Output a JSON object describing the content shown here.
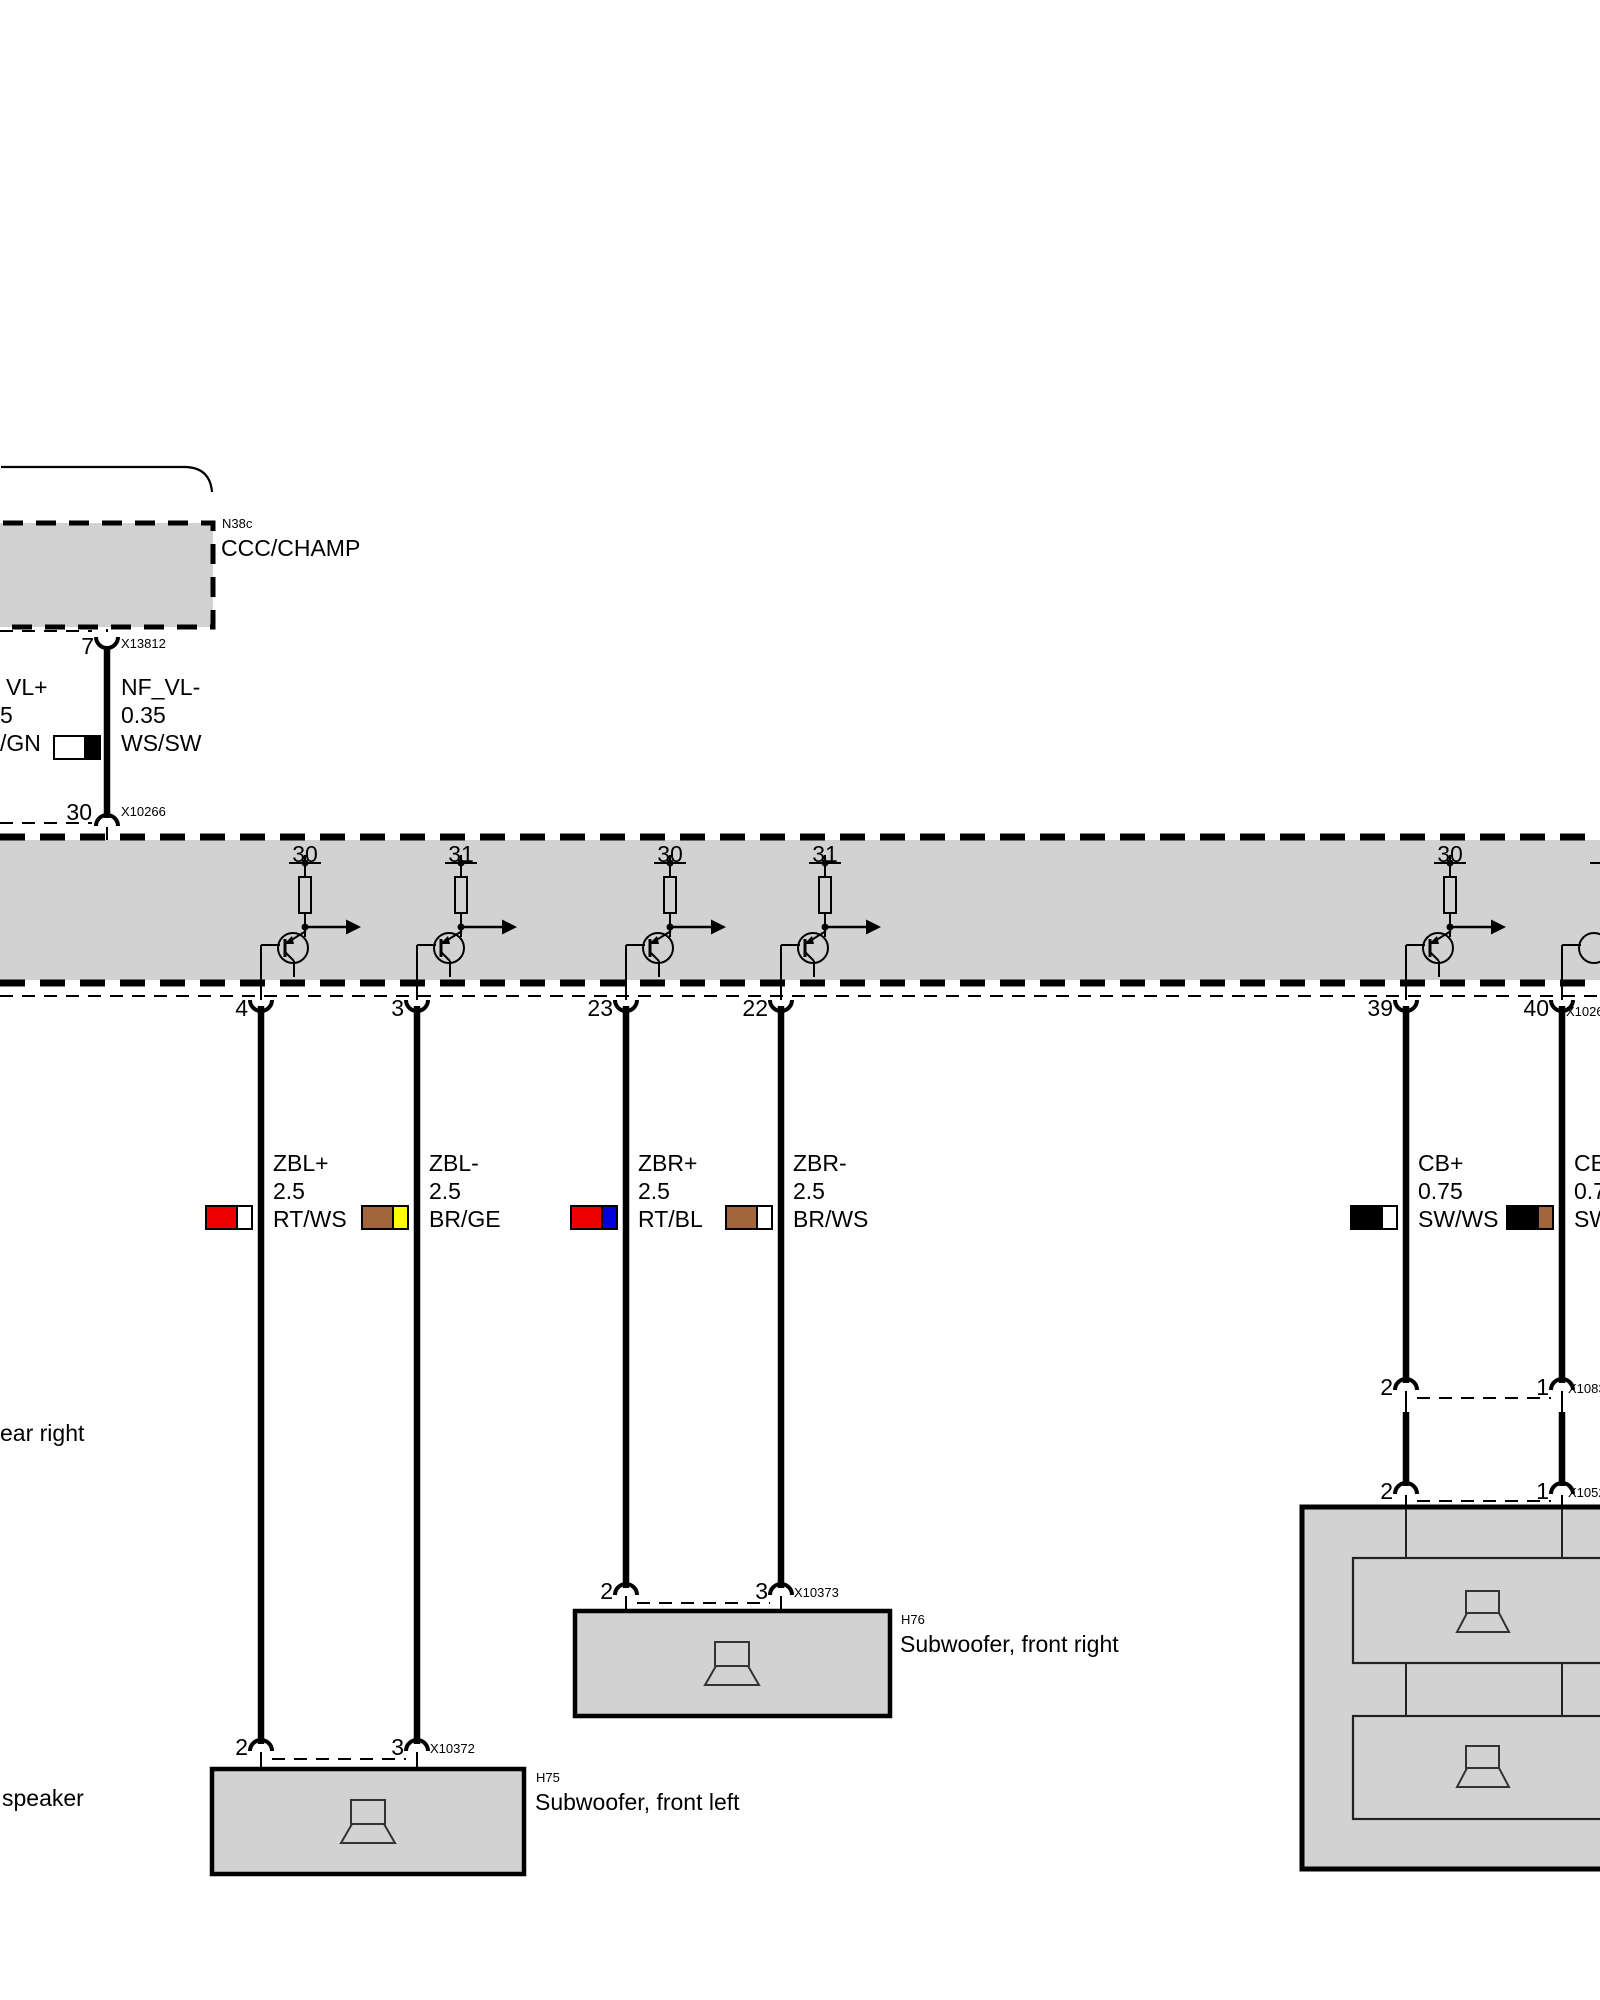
{
  "diagram": {
    "ccc": {
      "id": "N38c",
      "name": "CCC/CHAMP"
    },
    "conn7": {
      "pin": "7",
      "id": "X13812"
    },
    "cut_wire": {
      "lines": [
        "VL+",
        "5",
        "/GN"
      ]
    },
    "nf_wire": {
      "lines": [
        "NF_VL-",
        "0.35",
        "WS/SW"
      ],
      "colors": [
        "#ffffff",
        "#000000"
      ]
    },
    "conn30": {
      "pin": "30",
      "id": "X10266"
    },
    "amp": {
      "supply_pins": [
        "30",
        "31",
        "30",
        "31",
        "30"
      ],
      "out_pins": [
        "4",
        "3",
        "23",
        "22",
        "39",
        "40"
      ],
      "edge_conn_id": "X1026"
    },
    "wires": [
      {
        "lines": [
          "ZBL+",
          "2.5",
          "RT/WS"
        ],
        "colors": [
          "#ee0000",
          "#ffffff"
        ]
      },
      {
        "lines": [
          "ZBL-",
          "2.5",
          "BR/GE"
        ],
        "colors": [
          "#a2653c",
          "#ffff00"
        ]
      },
      {
        "lines": [
          "ZBR+",
          "2.5",
          "RT/BL"
        ],
        "colors": [
          "#ee0000",
          "#0000dd"
        ]
      },
      {
        "lines": [
          "ZBR-",
          "2.5",
          "BR/WS"
        ],
        "colors": [
          "#a2653c",
          "#ffffff"
        ]
      },
      {
        "lines": [
          "CB+",
          "0.75",
          "SW/WS"
        ],
        "colors": [
          "#000000",
          "#ffffff"
        ]
      },
      {
        "lines": [
          "CB",
          "0.7",
          "SW"
        ],
        "colors": [
          "#000000",
          "#a2653c"
        ]
      }
    ],
    "fragments": {
      "rear_right": "ear right",
      "speaker": "speaker"
    },
    "h76": {
      "id": "H76",
      "name": "Subwoofer, front right",
      "conn": "X10373",
      "pin_left": "2",
      "pin_right": "3"
    },
    "h75": {
      "id": "H75",
      "name": "Subwoofer, front left",
      "conn": "X10372",
      "pin_left": "2",
      "pin_right": "3"
    },
    "rows": [
      {
        "pin_left": "2",
        "pin_right": "1",
        "id": "X1083"
      },
      {
        "pin_left": "2",
        "pin_right": "1",
        "id": "X1052"
      }
    ],
    "colors": {
      "module_fill": "#d2d2d2",
      "line": "#000000"
    }
  }
}
